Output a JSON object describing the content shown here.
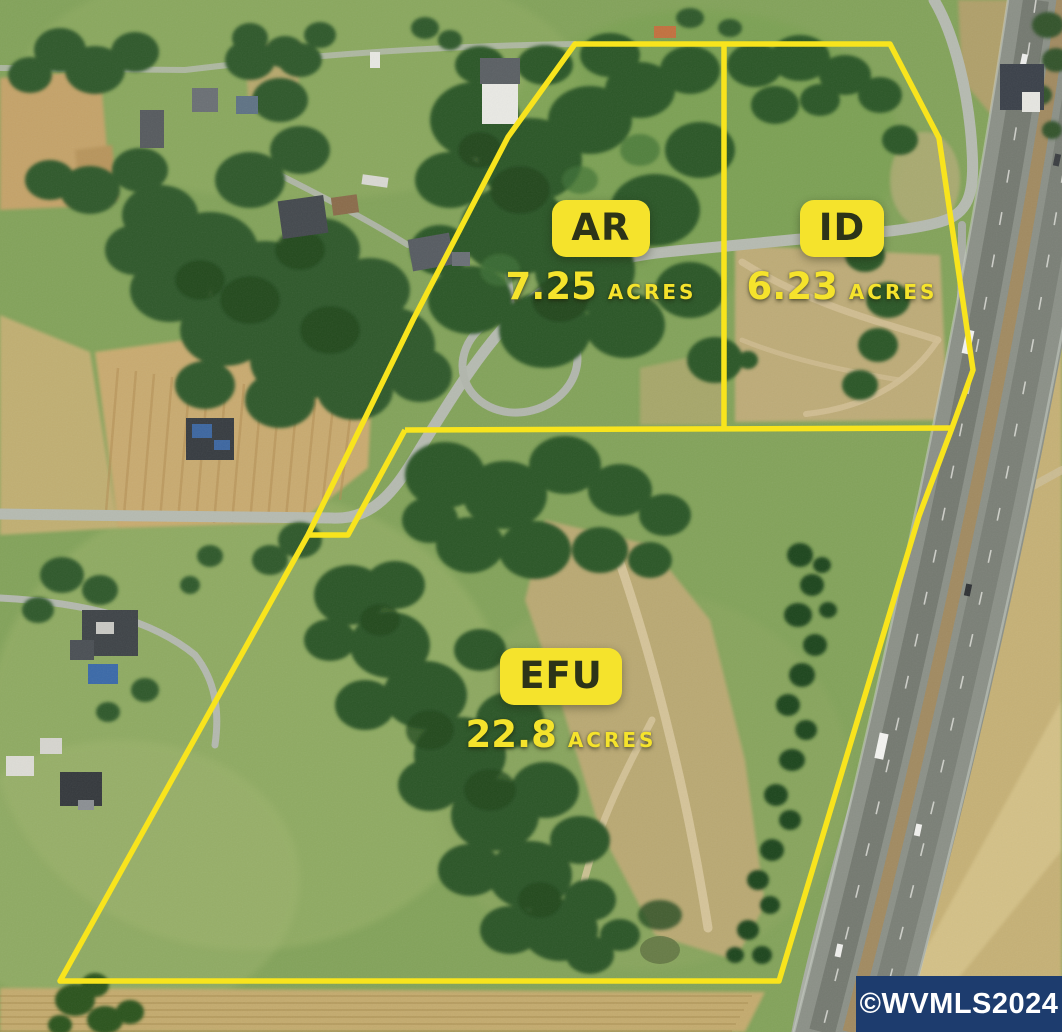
{
  "parcel_map": {
    "description": "Aerial parcel / zoning map with highway at right",
    "parcels": [
      {
        "code": "AR",
        "acres": "7.25",
        "unit": "ACRES"
      },
      {
        "code": "ID",
        "acres": "6.23",
        "unit": "ACRES"
      },
      {
        "code": "EFU",
        "acres": "22.8",
        "unit": "ACRES"
      }
    ],
    "watermark": "©WVMLS2024",
    "colors": {
      "boundary": "#F8E41D",
      "label_bg": "#F5E32C",
      "label_text": "#2D3418",
      "acres_text": "#F5E32C",
      "watermark_bg": "#1D3C6E",
      "watermark_text": "#FFFFFF"
    }
  }
}
